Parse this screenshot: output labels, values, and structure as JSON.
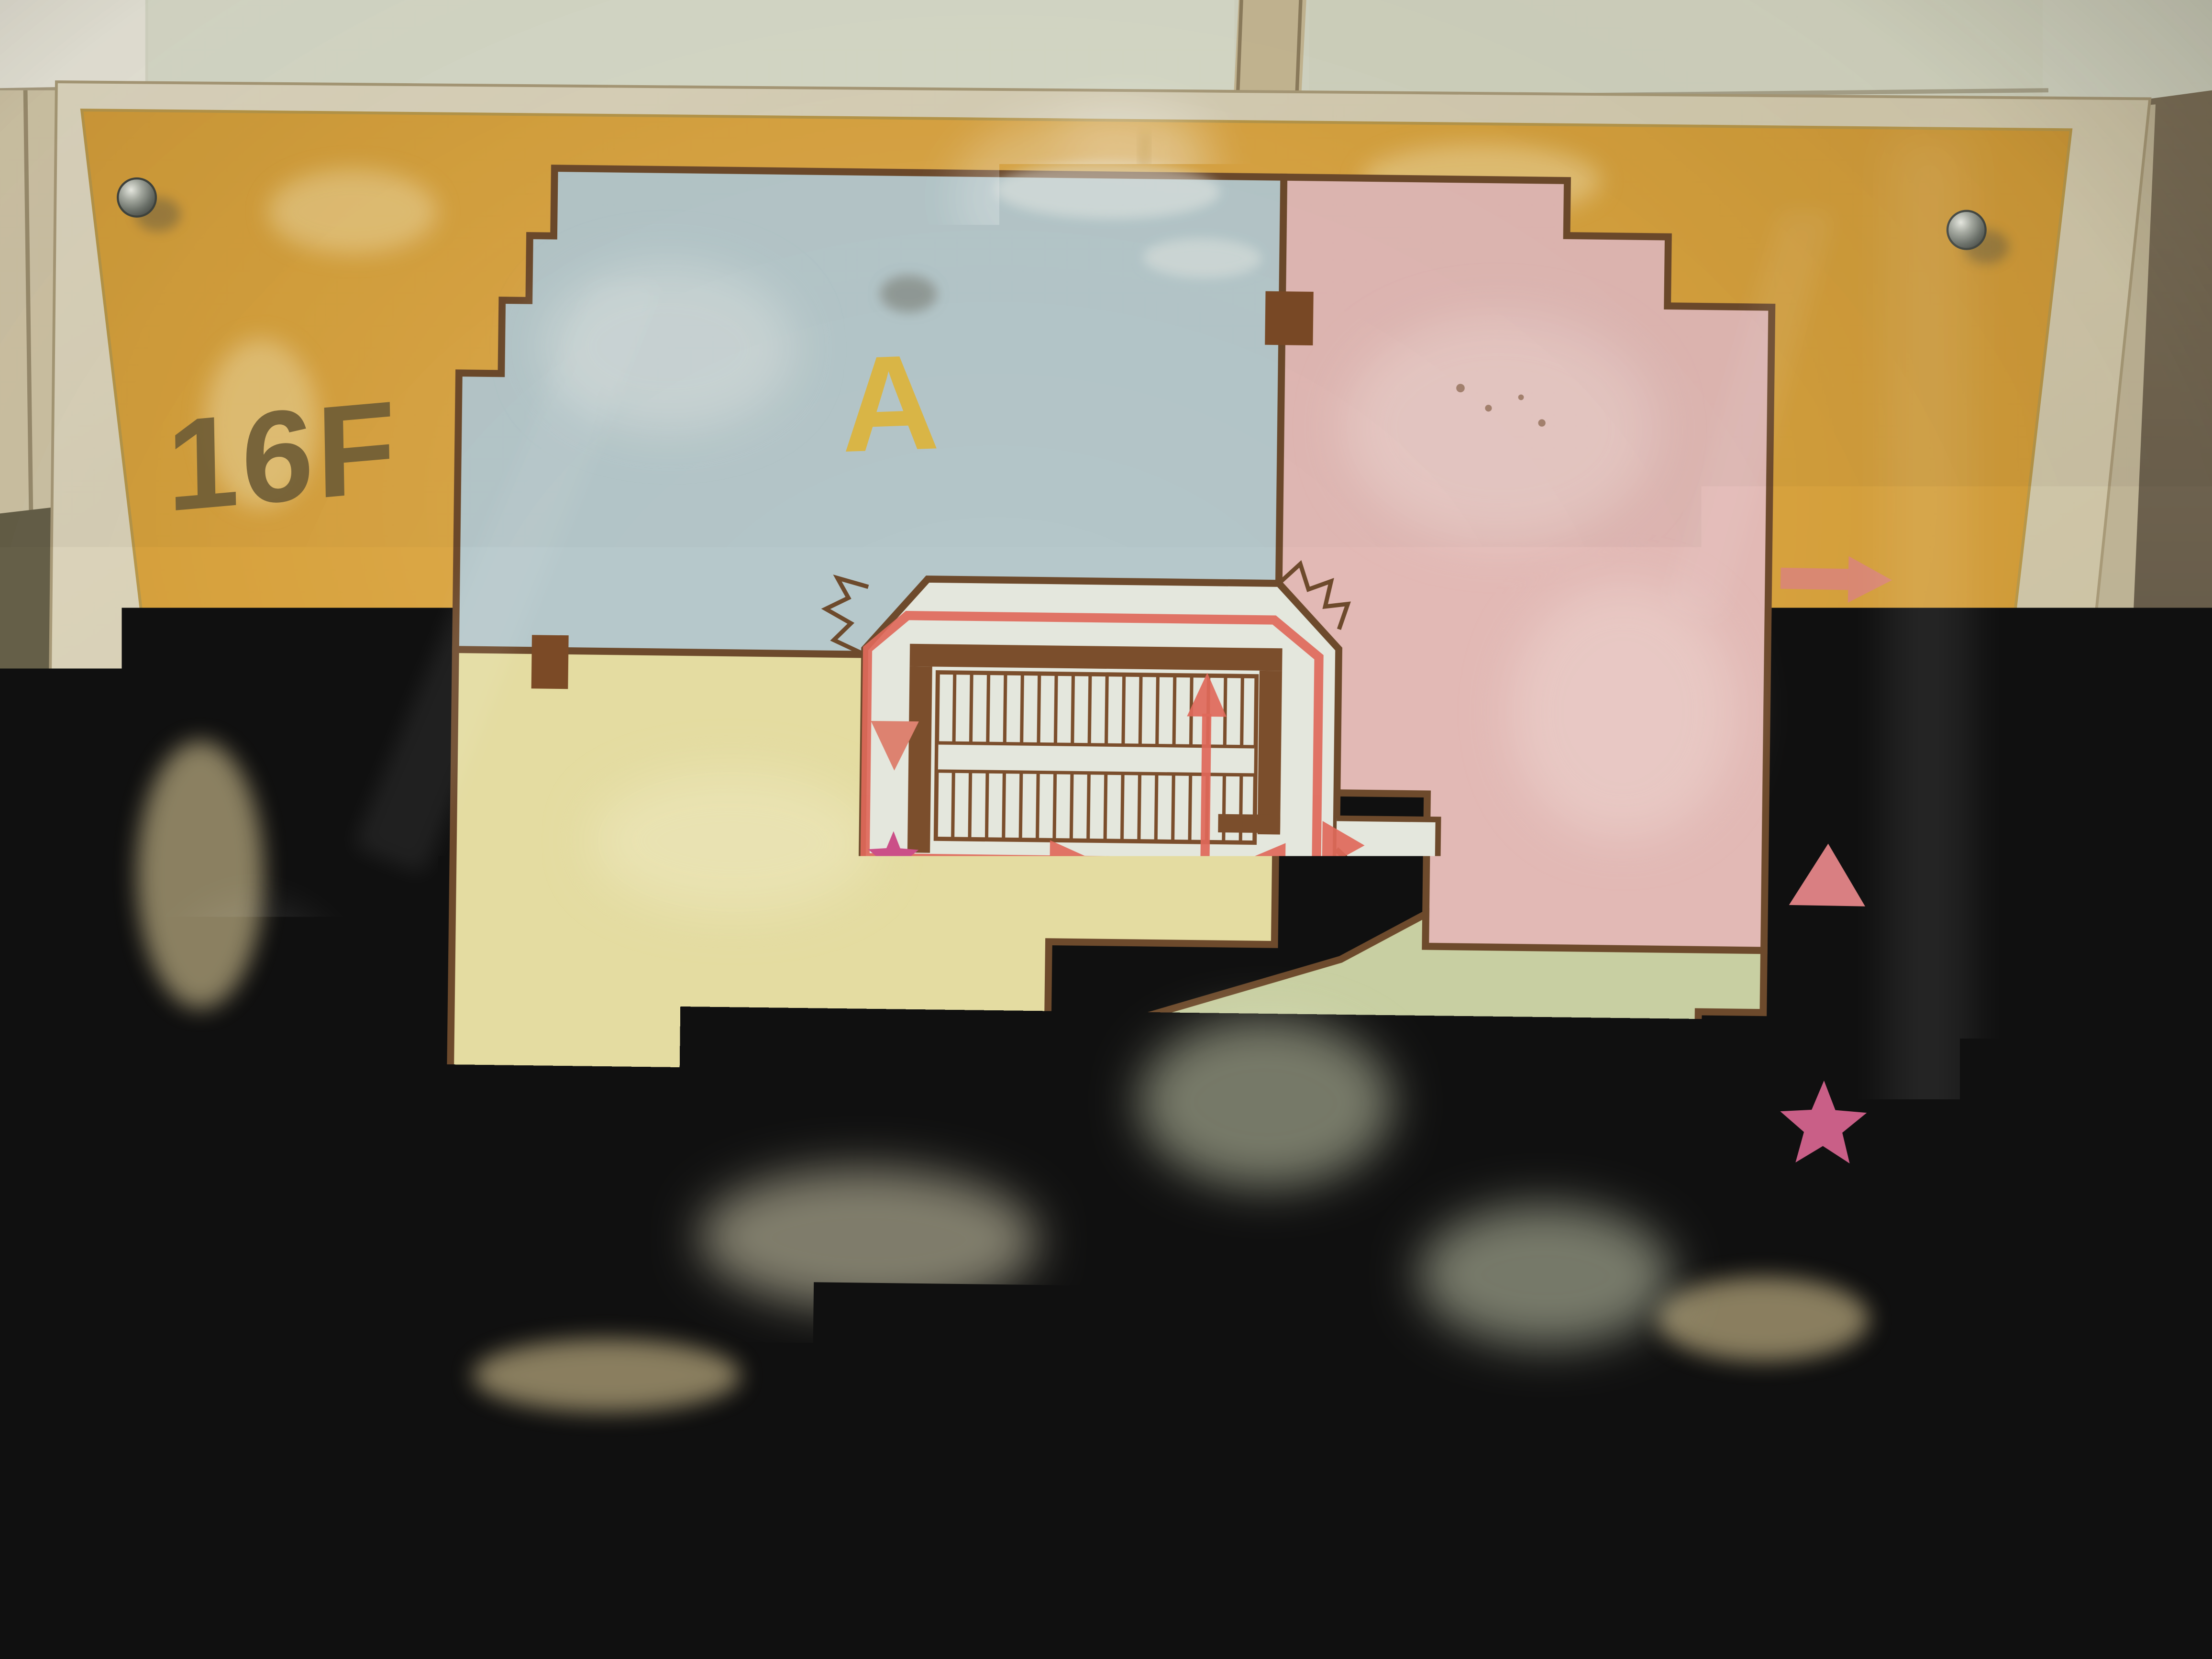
{
  "sign": {
    "floor_label": "16F",
    "title_vertical": "疏散平面图",
    "watermark": "ESCAPE WAY",
    "zones": [
      {
        "id": "A",
        "fill_color": "#b6c8cb",
        "letter_color": "#dcb53f"
      },
      {
        "id": "B",
        "fill_color": "#e4dca1",
        "letter_color": "#c8854a"
      },
      {
        "id": "C",
        "fill_color": "#c8cfa2",
        "letter_color": "#8ea4b4"
      },
      {
        "id": "D",
        "fill_color": "#e2b9b5",
        "letter_color": "#adc29c"
      }
    ],
    "legend": {
      "items": [
        {
          "symbol": "arrow-right-icon",
          "label": "疏散通道"
        },
        {
          "symbol": "fire-hydrant-triangle-icon",
          "label": "消防栓"
        },
        {
          "symbol": "fire-extinguisher-star-icon",
          "label": "灭火器"
        }
      ]
    },
    "colors": {
      "sign_background": "#d9a33c",
      "plan_outline": "#6d4a2c",
      "escape_route": "#e0695a",
      "hydrant_symbol": "#dd8270",
      "extinguisher_symbol": "#cb4f88",
      "core_floor": "#e4e7dd",
      "frame": "#d6cdb2"
    }
  }
}
